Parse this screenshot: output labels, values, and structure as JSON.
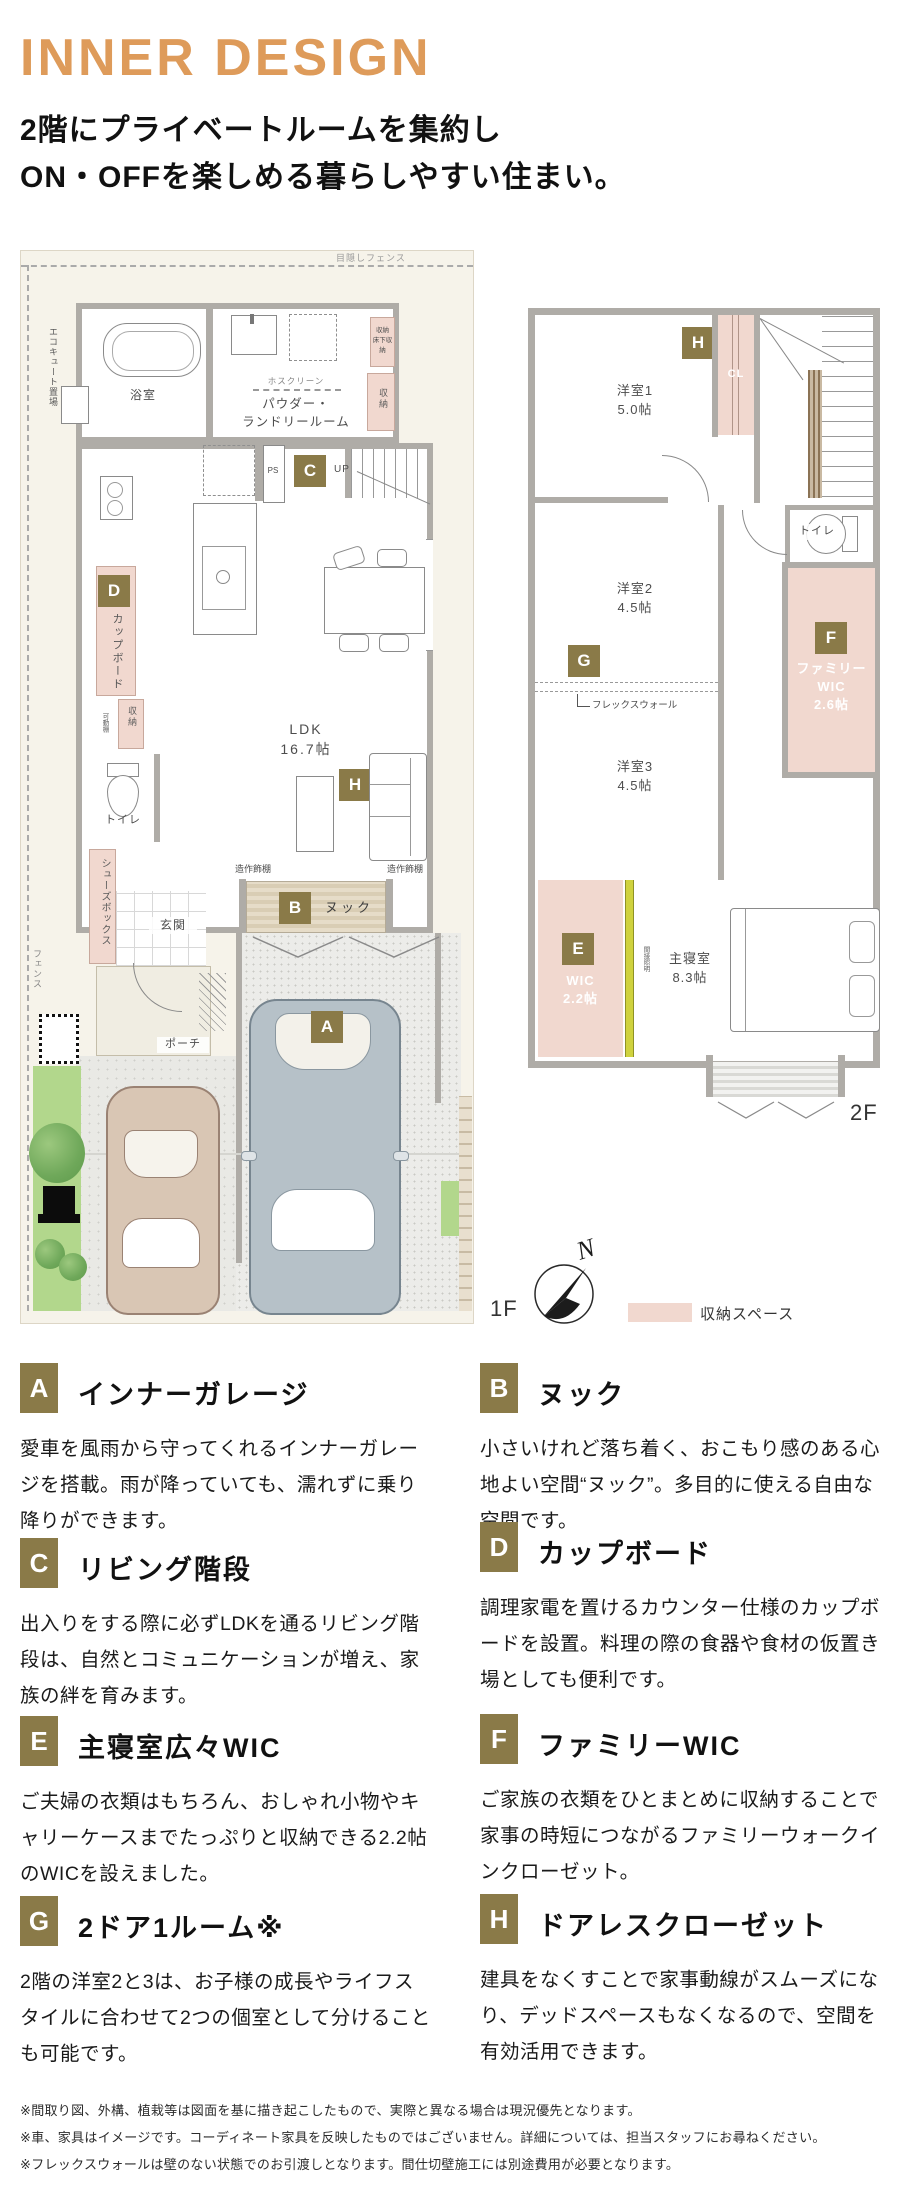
{
  "colors": {
    "accent_gold": "#8A7A48",
    "title_orange": "#DE9B5A",
    "storage_pink": "#F1D8CF",
    "wall_gray": "#AFACA7",
    "site_cream": "#F6F3EA",
    "indirect_yellow": "#CFD23E"
  },
  "header": {
    "title": "INNER DESIGN",
    "subtitle_line1": "2階にプライベートルームを集約し",
    "subtitle_line2": "ON・OFFを楽しめる暮らしやすい住まい。"
  },
  "plan1f": {
    "labels": {
      "mekakushi_fence": "目隠しフェンス",
      "ecocute": "エコキュート置場",
      "bath": "浴室",
      "hosclean": "ホスクリーン",
      "powder_line1": "パウダー・",
      "powder_line2": "ランドリールーム",
      "storage_top_line1": "収納",
      "storage_top_line2": "床下収納",
      "storage_top2": "収納",
      "ps": "PS",
      "up": "UP",
      "cupboard": "カップボード",
      "ldk_line1": "LDK",
      "ldk_line2": "16.7帖",
      "storage_mid": "収納",
      "movable_shelf": "可動棚",
      "toilet": "トイレ",
      "shelf_label": "造作飾棚",
      "nook": "ヌック",
      "shoebox": "シューズボックス",
      "entrance": "玄関",
      "porch": "ポーチ",
      "fence_side": "フェンス",
      "floor": "1F"
    }
  },
  "plan2f": {
    "labels": {
      "room1_line1": "洋室1",
      "room1_line2": "5.0帖",
      "cl": "CL",
      "toilet": "トイレ",
      "room2_line1": "洋室2",
      "room2_line2": "4.5帖",
      "flexwall": "フレックスウォール",
      "room3_line1": "洋室3",
      "room3_line2": "4.5帖",
      "fwic_line1": "ファミリー",
      "fwic_line2": "WIC",
      "fwic_line3": "2.6帖",
      "wic_line1": "WIC",
      "wic_line2": "2.2帖",
      "indirect": "間接照明",
      "master_line1": "主寝室",
      "master_line2": "8.3帖",
      "floor": "2F"
    }
  },
  "compass": {
    "north": "N"
  },
  "legend": {
    "storage": "収納スペース"
  },
  "features": [
    {
      "letter": "A",
      "title": "インナーガレージ",
      "body": "愛車を風雨から守ってくれるインナーガレージを搭載。雨が降っていても、濡れずに乗り降りができます。"
    },
    {
      "letter": "B",
      "title": "ヌック",
      "body": "小さいけれど落ち着く、おこもり感のある心地よい空間“ヌック”。多目的に使える自由な空間です。"
    },
    {
      "letter": "C",
      "title": "リビング階段",
      "body": "出入りをする際に必ずLDKを通るリビング階段は、自然とコミュニケーションが増え、家族の絆を育みます。"
    },
    {
      "letter": "D",
      "title": "カップボード",
      "body": "調理家電を置けるカウンター仕様のカップボードを設置。料理の際の食器や食材の仮置き場としても便利です。"
    },
    {
      "letter": "E",
      "title": "主寝室広々WIC",
      "body": "ご夫婦の衣類はもちろん、おしゃれ小物やキャリーケースまでたっぷりと収納できる2.2帖のWICを設えました。"
    },
    {
      "letter": "F",
      "title": "ファミリーWIC",
      "body": "ご家族の衣類をひとまとめに収納することで家事の時短につながるファミリーウォークインクローゼット。"
    },
    {
      "letter": "G",
      "title": "2ドア1ルーム※",
      "body": "2階の洋室2と3は、お子様の成長やライフスタイルに合わせて2つの個室として分けることも可能です。"
    },
    {
      "letter": "H",
      "title": "ドアレスクローゼット",
      "body": "建具をなくすことで家事動線がスムーズになり、デッドスペースもなくなるので、空間を有効活用できます。"
    }
  ],
  "footnotes": [
    "※間取り図、外構、植栽等は図面を基に描き起こしたもので、実際と異なる場合は現況優先となります。",
    "※車、家具はイメージです。コーディネート家具を反映したものではございません。詳細については、担当スタッフにお尋ねください。",
    "※フレックスウォールは壁のない状態でのお引渡しとなります。間仕切壁施工には別途費用が必要となります。"
  ]
}
